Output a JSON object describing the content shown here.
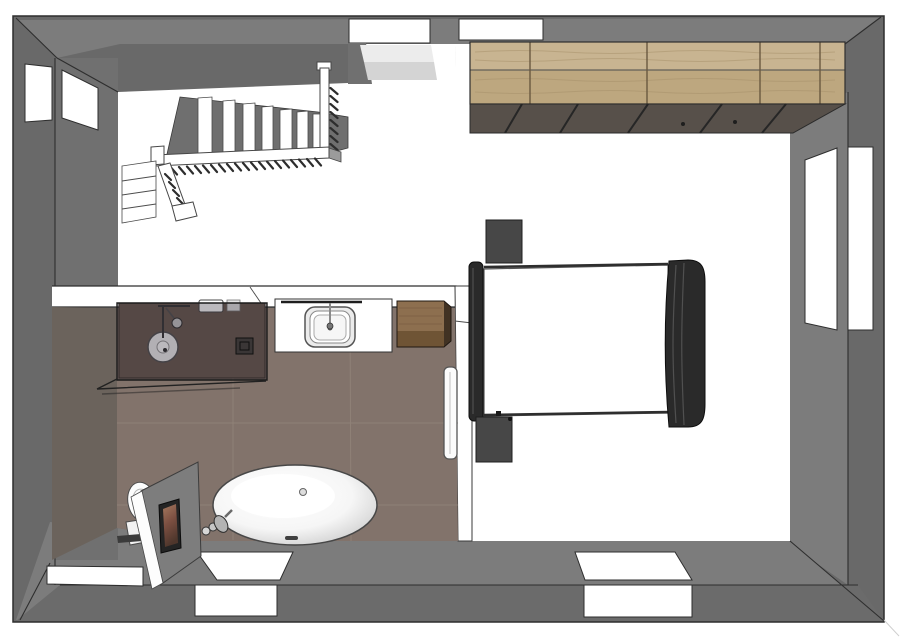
{
  "scene": {
    "type": "3d-floor-plan-top-down-rendering",
    "rooms": [
      {
        "name": "staircase-hall",
        "floor": "white"
      },
      {
        "name": "bathroom",
        "floor": "brown-tile"
      },
      {
        "name": "bedroom",
        "floor": "white"
      }
    ],
    "fixtures": [
      "l-shaped-staircase-with-railing",
      "walk-in-shower-glass-enclosure",
      "washbasin-vanity",
      "wood-cabinet",
      "towel-radiator",
      "freestanding-oval-bathtub",
      "floor-mounted-tub-faucet",
      "toilet-behind-partition",
      "partition-wall-with-picture",
      "sliding-door-wardrobe",
      "double-bed",
      "nightstand-left-top",
      "nightstand-left-bottom"
    ],
    "windows": [
      "left-wall-window",
      "top-wall-window-staircase",
      "top-wall-window-bedroom",
      "right-wall-window",
      "bathroom-south-window",
      "bedroom-south-window",
      "southwest-niche"
    ]
  },
  "stairs": {
    "upper_steps": 7,
    "lower_steps": 3,
    "baluster_marks_horizontal": 20,
    "baluster_marks_vertical": 8
  },
  "wardrobe": {
    "sections": 5
  },
  "colors": {
    "canvas_bg": "#ffffff",
    "wall_outer": "#696969",
    "wall_top": "#7c7c7c",
    "wall_inner": "#707070",
    "bottom_face": "#6b6b6b",
    "void_gray": "#6f6f6f",
    "line_dark": "#2e2e2e",
    "floor_white": "#ffffff",
    "bath_floor": "#82736b",
    "bath_grout": "#97887e",
    "bath_west": "#6b635c",
    "shower_floor": "#6e5d53",
    "glass_tint": "rgba(30,24,36,0.30)",
    "wood_top": "#c8b491",
    "wood_front": "#bda77f",
    "wood_grain": "#a68f69",
    "wood_divider": "#6a5940",
    "track": "#57504a",
    "cab_top": "#8d6f4f",
    "cab_front": "#6f5435",
    "cab_side": "#413223",
    "bed_frame": "#2a2a2a",
    "bed_hi": "#505050",
    "nightstand": "#474747",
    "fixt_stroke": "#4a4a4a",
    "chrome": "#c9c9c9",
    "partition": "#7d7d7d",
    "pic_frame": "#242424",
    "pic_top": "#a5795f",
    "pic_mid": "#7c4f41",
    "pic_bottom": "#4e362c",
    "tub_edge": "#c3c3c3",
    "hatch": "#2d2d2d",
    "reveal1": "#ececec",
    "reveal2": "#d4d4d4"
  }
}
